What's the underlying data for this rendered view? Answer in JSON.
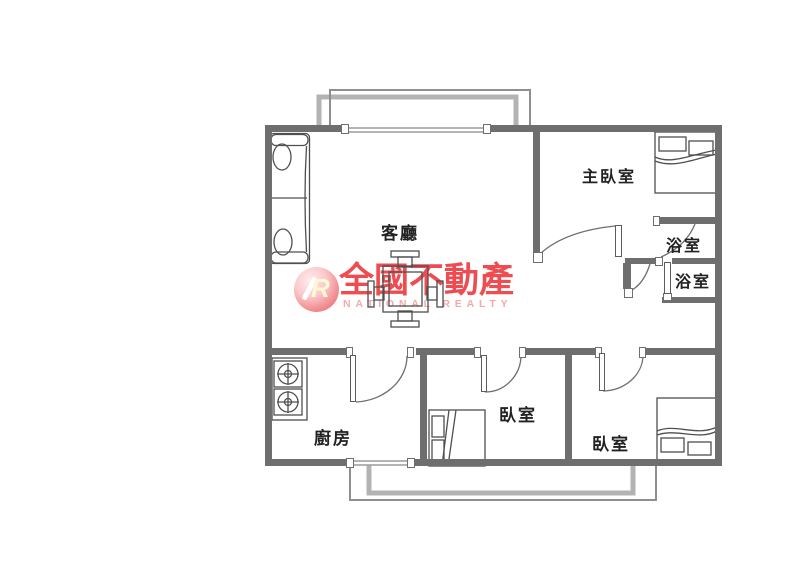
{
  "colors": {
    "bg": "#ffffff",
    "wall": "#6e6e6e",
    "furniture_line": "#4f4f4f",
    "balcony_light": "#b3b3b3",
    "balcony_outline": "#8f8f8f",
    "label_text": "#222222",
    "brand_red": "#ee4348",
    "brand_pink": "#f5a9ad"
  },
  "rooms": {
    "living": {
      "label": "客廳"
    },
    "master_bedroom": {
      "label": "主臥室"
    },
    "bathroom_top": {
      "label": "浴室"
    },
    "bathroom_bottom": {
      "label": "浴室"
    },
    "kitchen": {
      "label": "廚房"
    },
    "bedroom_middle": {
      "label": "臥室"
    },
    "bedroom_right": {
      "label": "臥室"
    }
  },
  "watermark": {
    "logo_letter": "R",
    "brand_name": "全國不動產",
    "brand_subtitle": "NATIONAL REALTY"
  }
}
